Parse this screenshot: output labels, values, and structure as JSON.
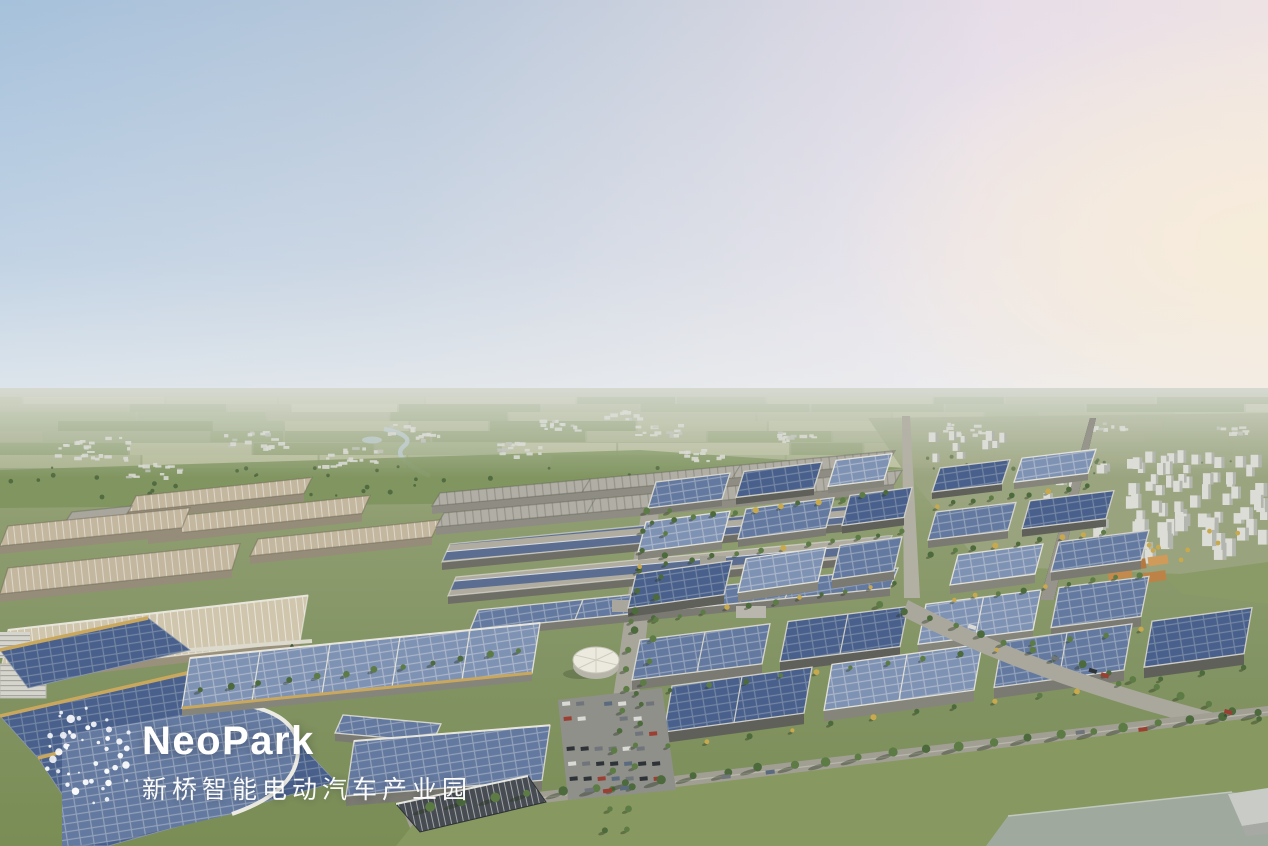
{
  "logo": {
    "name": "NeoPark",
    "subtitle": "新桥智能电动汽车产业园",
    "mark_icon": "dot-constellation-logo",
    "color": "#ffffff"
  },
  "palette": {
    "sky_blue": "#a6c1db",
    "sky_pink": "#e6dde8",
    "sky_warm": "#f7ecd9",
    "horizon_haze": "#b6bdab",
    "field_green": "#8e9e70",
    "lawn_green": "#879860",
    "tree_green": "#4c6a3c",
    "tree_yellow": "#c9a94e",
    "solar_dark": "#49608c",
    "solar_mid": "#64799f",
    "solar_light": "#7e92b4",
    "roof_tan": "#c3b89f",
    "roof_gray": "#b1afa5",
    "wall_light": "#b7b7b0",
    "gold_trim": "#c9a85e",
    "road_gray": "#a8a69b",
    "white_building": "#d8d9d2",
    "water_gray": "#9fa99e"
  }
}
